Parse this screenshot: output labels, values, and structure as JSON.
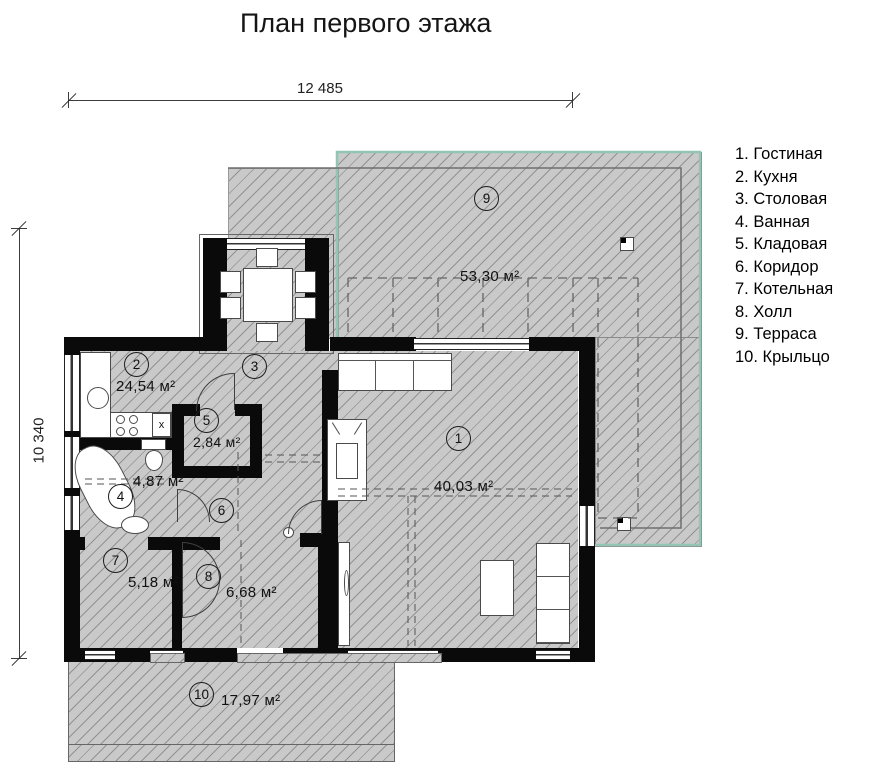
{
  "title": "План первого этажа",
  "dimensions": {
    "width": "12 485",
    "height": "10 340"
  },
  "legend": {
    "items": [
      "1. Гостиная",
      "2. Кухня",
      "3. Столовая",
      "4. Ванная",
      "5. Кладовая",
      "6. Коридор",
      "7. Котельная",
      "8. Холл",
      "9. Терраса",
      "10. Крыльцо"
    ]
  },
  "rooms": {
    "living": {
      "num": "1",
      "name": "Гостиная",
      "area": "40,03 м²"
    },
    "kitchen": {
      "num": "2",
      "name": "Кухня",
      "area": "24,54 м²"
    },
    "dining": {
      "num": "3",
      "name": "Столовая"
    },
    "bath": {
      "num": "4",
      "name": "Ванная",
      "area": "4,87 м²"
    },
    "storage": {
      "num": "5",
      "name": "Кладовая",
      "area": "2,84 м²"
    },
    "corridor": {
      "num": "6",
      "name": "Коридор"
    },
    "boiler": {
      "num": "7",
      "name": "Котельная",
      "area": "5,18 м²"
    },
    "hall": {
      "num": "8",
      "name": "Холл",
      "area": "6,68 м²"
    },
    "terrace": {
      "num": "9",
      "name": "Терраса",
      "area": "53,30 м²"
    },
    "porch": {
      "num": "10",
      "name": "Крыльцо",
      "area": "17,97 м²"
    }
  },
  "stairs": {
    "steps": [
      "1",
      "2",
      "3",
      "4",
      "5",
      "6",
      "7",
      "8",
      "9",
      "10"
    ]
  },
  "fixtures": {
    "dishwasher_mark": "x"
  },
  "colors": {
    "terrace_outline": "#93c4b4",
    "wall": "#000000",
    "hatch_fill": "#c9c9c9",
    "text": "#1a1a1a"
  }
}
